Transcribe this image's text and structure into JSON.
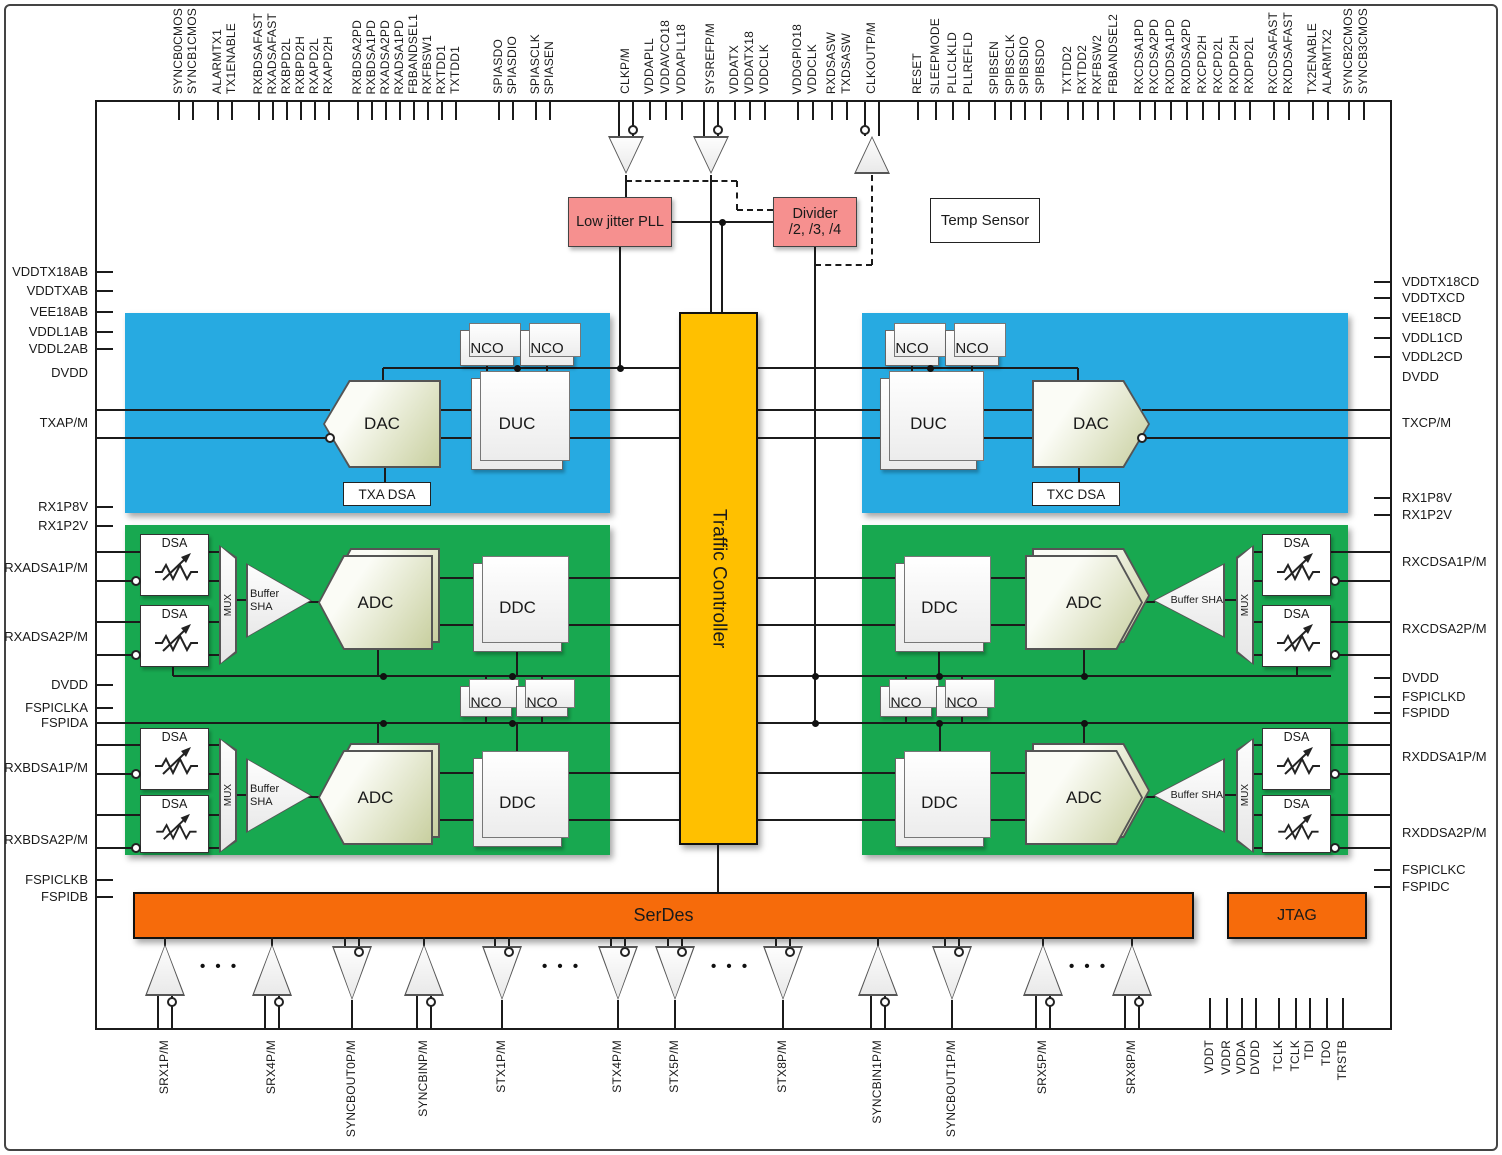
{
  "colors": {
    "blue": "#27AAE1",
    "green": "#18A850",
    "yellow": "#FFC000",
    "orange": "#F66B0B",
    "pink": "#F6908F"
  },
  "labels": {
    "pll": "Low jitter PLL",
    "divider1": "Divider",
    "divider2": "/2, /3, /4",
    "temp_sensor": "Temp Sensor",
    "traffic_controller": "Traffic Controller",
    "serdes": "SerDes",
    "jtag": "JTAG",
    "nco": "NCO",
    "duc": "DUC",
    "ddc": "DDC",
    "dac": "DAC",
    "adc": "ADC",
    "dsa": "DSA",
    "mux": "MUX",
    "buffer_sha": "Buffer SHA",
    "txa_dsa": "TXA DSA",
    "txc_dsa": "TXC DSA"
  },
  "pins": {
    "top": [
      {
        "x": 179,
        "label": "SYNCB0CMOS"
      },
      {
        "x": 193,
        "label": "SYNCB1CMOS"
      },
      {
        "x": 218,
        "label": "ALARMTX1"
      },
      {
        "x": 232,
        "label": "TX1ENABLE"
      },
      {
        "x": 259,
        "label": "RXBDSAFAST"
      },
      {
        "x": 273,
        "label": "RXADSAFAST"
      },
      {
        "x": 287,
        "label": "RXBPD2L"
      },
      {
        "x": 301,
        "label": "RXBPD2H"
      },
      {
        "x": 315,
        "label": "RXAPD2L"
      },
      {
        "x": 329,
        "label": "RXAPD2H"
      },
      {
        "x": 358,
        "label": "RXBDSA2PD"
      },
      {
        "x": 372,
        "label": "RXBDSA1PD"
      },
      {
        "x": 386,
        "label": "RXADSA2PD"
      },
      {
        "x": 400,
        "label": "RXADSA1PD"
      },
      {
        "x": 414,
        "label": "FBBANDSEL1"
      },
      {
        "x": 428,
        "label": "RXFBSW1"
      },
      {
        "x": 442,
        "label": "RXTDD1"
      },
      {
        "x": 456,
        "label": "TXTDD1"
      },
      {
        "x": 499,
        "label": "SPIASDO"
      },
      {
        "x": 513,
        "label": "SPIASDIO"
      },
      {
        "x": 536,
        "label": "SPIASCLK"
      },
      {
        "x": 550,
        "label": "SPIASEN"
      },
      {
        "x": 626,
        "label": "CLKP/M",
        "tick": false
      },
      {
        "x": 650,
        "label": "VDDAPLL"
      },
      {
        "x": 666,
        "label": "VDDAVCO18"
      },
      {
        "x": 682,
        "label": "VDDAPLL18"
      },
      {
        "x": 711,
        "label": "SYSREFP/M",
        "tick": false
      },
      {
        "x": 735,
        "label": "VDDATX"
      },
      {
        "x": 750,
        "label": "VDDATX18"
      },
      {
        "x": 765,
        "label": "VDDCLK"
      },
      {
        "x": 798,
        "label": "VDDGPIO18"
      },
      {
        "x": 813,
        "label": "VDDCLK"
      },
      {
        "x": 832,
        "label": "RXDSASW"
      },
      {
        "x": 847,
        "label": "TXDSASW"
      },
      {
        "x": 872,
        "label": "CLKOUTP/M",
        "tick": false
      },
      {
        "x": 918,
        "label": "RESET"
      },
      {
        "x": 936,
        "label": "SLEEPMODE"
      },
      {
        "x": 953,
        "label": "PLLCLKLD"
      },
      {
        "x": 969,
        "label": "PLLREFLD"
      },
      {
        "x": 995,
        "label": "SPIBSEN"
      },
      {
        "x": 1011,
        "label": "SPIBSCLK"
      },
      {
        "x": 1025,
        "label": "SPIBSDIO"
      },
      {
        "x": 1041,
        "label": "SPIBSDO"
      },
      {
        "x": 1068,
        "label": "TXTDD2"
      },
      {
        "x": 1083,
        "label": "RXTDD2"
      },
      {
        "x": 1098,
        "label": "RXFBSW2"
      },
      {
        "x": 1114,
        "label": "FBBANDSEL2"
      },
      {
        "x": 1140,
        "label": "RXCDSA1PD"
      },
      {
        "x": 1155,
        "label": "RXCDSA2PD"
      },
      {
        "x": 1171,
        "label": "RXDDSA1PD"
      },
      {
        "x": 1187,
        "label": "RXDDSA2PD"
      },
      {
        "x": 1203,
        "label": "RXCPD2H"
      },
      {
        "x": 1219,
        "label": "RXCPD2L"
      },
      {
        "x": 1235,
        "label": "RXDPD2H"
      },
      {
        "x": 1250,
        "label": "RXDPD2L"
      },
      {
        "x": 1274,
        "label": "RXCDSAFAST"
      },
      {
        "x": 1289,
        "label": "RXDDSAFAST"
      },
      {
        "x": 1313,
        "label": "TX2ENABLE"
      },
      {
        "x": 1328,
        "label": "ALARMTX2"
      },
      {
        "x": 1349,
        "label": "SYNCB2CMOS"
      },
      {
        "x": 1364,
        "label": "SYNCB3CMOS"
      }
    ],
    "left": [
      {
        "y": 272,
        "label": "VDDTX18AB"
      },
      {
        "y": 291,
        "label": "VDDTXAB"
      },
      {
        "y": 312,
        "label": "VEE18AB"
      },
      {
        "y": 332,
        "label": "VDDL1AB"
      },
      {
        "y": 349,
        "label": "VDDL2AB"
      },
      {
        "y": 373,
        "label": "DVDD",
        "tick": false
      },
      {
        "y": 423,
        "label": "TXAP/M",
        "tick": false
      },
      {
        "y": 507,
        "label": "RX1P8V"
      },
      {
        "y": 526,
        "label": "RX1P2V"
      },
      {
        "y": 568,
        "label": "RXADSA1P/M",
        "tick": false
      },
      {
        "y": 637,
        "label": "RXADSA2P/M",
        "tick": false
      },
      {
        "y": 685,
        "label": "DVDD"
      },
      {
        "y": 708,
        "label": "FSPICLKA"
      },
      {
        "y": 723,
        "label": "FSPIDA"
      },
      {
        "y": 768,
        "label": "RXBDSA1P/M",
        "tick": false
      },
      {
        "y": 840,
        "label": "RXBDSA2P/M",
        "tick": false
      },
      {
        "y": 880,
        "label": "FSPICLKB"
      },
      {
        "y": 897,
        "label": "FSPIDB"
      }
    ],
    "right": [
      {
        "y": 282,
        "label": "VDDTX18CD"
      },
      {
        "y": 298,
        "label": "VDDTXCD"
      },
      {
        "y": 318,
        "label": "VEE18CD"
      },
      {
        "y": 338,
        "label": "VDDL1CD"
      },
      {
        "y": 357,
        "label": "VDDL2CD"
      },
      {
        "y": 377,
        "label": "DVDD",
        "tick": false
      },
      {
        "y": 423,
        "label": "TXCP/M",
        "tick": false
      },
      {
        "y": 498,
        "label": "RX1P8V"
      },
      {
        "y": 515,
        "label": "RX1P2V"
      },
      {
        "y": 562,
        "label": "RXCDSA1P/M",
        "tick": false
      },
      {
        "y": 629,
        "label": "RXCDSA2P/M",
        "tick": false
      },
      {
        "y": 678,
        "label": "DVDD"
      },
      {
        "y": 697,
        "label": "FSPICLKD"
      },
      {
        "y": 713,
        "label": "FSPIDD"
      },
      {
        "y": 757,
        "label": "RXDDSA1P/M",
        "tick": false
      },
      {
        "y": 833,
        "label": "RXDDSA2P/M",
        "tick": false
      },
      {
        "y": 870,
        "label": "FSPICLKC"
      },
      {
        "y": 887,
        "label": "FSPIDC"
      }
    ],
    "bottom": [
      {
        "x": 165,
        "label": "SRX1P/M",
        "tick": false
      },
      {
        "x": 272,
        "label": "SRX4P/M",
        "tick": false
      },
      {
        "x": 352,
        "label": "SYNCBOUT0P/M",
        "tick": false
      },
      {
        "x": 424,
        "label": "SYNCBINP/M",
        "tick": false
      },
      {
        "x": 502,
        "label": "STX1P/M",
        "tick": false
      },
      {
        "x": 618,
        "label": "STX4P/M",
        "tick": false
      },
      {
        "x": 675,
        "label": "STX5P/M",
        "tick": false
      },
      {
        "x": 783,
        "label": "STX8P/M",
        "tick": false
      },
      {
        "x": 878,
        "label": "SYNCBIN1P/M",
        "tick": false
      },
      {
        "x": 952,
        "label": "SYNCBOUT1P/M",
        "tick": false
      },
      {
        "x": 1043,
        "label": "SRX5P/M",
        "tick": false
      },
      {
        "x": 1132,
        "label": "SRX8P/M",
        "tick": false
      },
      {
        "x": 1210,
        "label": "VDDT"
      },
      {
        "x": 1227,
        "label": "VDDR"
      },
      {
        "x": 1242,
        "label": "VDDA"
      },
      {
        "x": 1256,
        "label": "DVDD"
      },
      {
        "x": 1279,
        "label": "TCLK"
      },
      {
        "x": 1296,
        "label": "TCLK"
      },
      {
        "x": 1310,
        "label": "TDI"
      },
      {
        "x": 1327,
        "label": "TDO"
      },
      {
        "x": 1343,
        "label": "TRSTB"
      }
    ]
  },
  "buffers": {
    "top": [
      {
        "x": 626,
        "dir": "down"
      },
      {
        "x": 711,
        "dir": "down"
      },
      {
        "x": 872,
        "dir": "up"
      }
    ],
    "bottom": [
      {
        "x": 165,
        "dir": "up"
      },
      {
        "x": 272,
        "dir": "up"
      },
      {
        "x": 352,
        "dir": "down"
      },
      {
        "x": 424,
        "dir": "up"
      },
      {
        "x": 502,
        "dir": "down"
      },
      {
        "x": 618,
        "dir": "down"
      },
      {
        "x": 675,
        "dir": "down"
      },
      {
        "x": 783,
        "dir": "down"
      },
      {
        "x": 878,
        "dir": "up"
      },
      {
        "x": 952,
        "dir": "down"
      },
      {
        "x": 1043,
        "dir": "up"
      },
      {
        "x": 1132,
        "dir": "up"
      }
    ],
    "ellipsis_x": [
      218,
      560,
      729,
      1087
    ]
  }
}
